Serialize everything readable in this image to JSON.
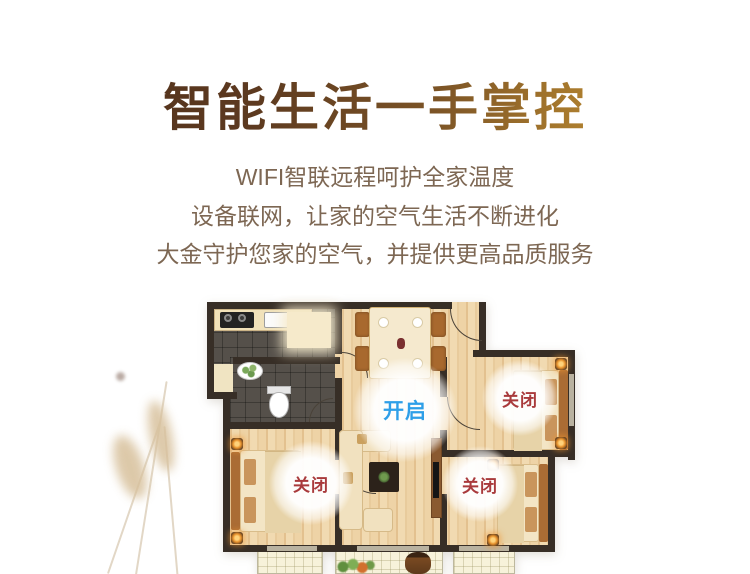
{
  "hero": {
    "title": "智能生活一手掌控",
    "lines": [
      "WIFI智联远程呵护全家温度",
      "设备联网，让家的空气生活不断进化",
      "大金守护您家的空气，并提供更高品质服务"
    ],
    "colors": {
      "title_gradient_from": "#4e2e1a",
      "title_gradient_to": "#ecc257",
      "body_text": "#7d6753"
    }
  },
  "floorplan": {
    "status": {
      "living": {
        "text": "开启",
        "state": "on"
      },
      "bedroom_top_right": {
        "text": "关闭",
        "state": "off"
      },
      "bedroom_left": {
        "text": "关闭",
        "state": "off"
      },
      "bedroom_bottom_right": {
        "text": "关闭",
        "state": "off"
      }
    },
    "colors": {
      "on": "#2e9fe8",
      "off": "#a93a3c"
    }
  }
}
